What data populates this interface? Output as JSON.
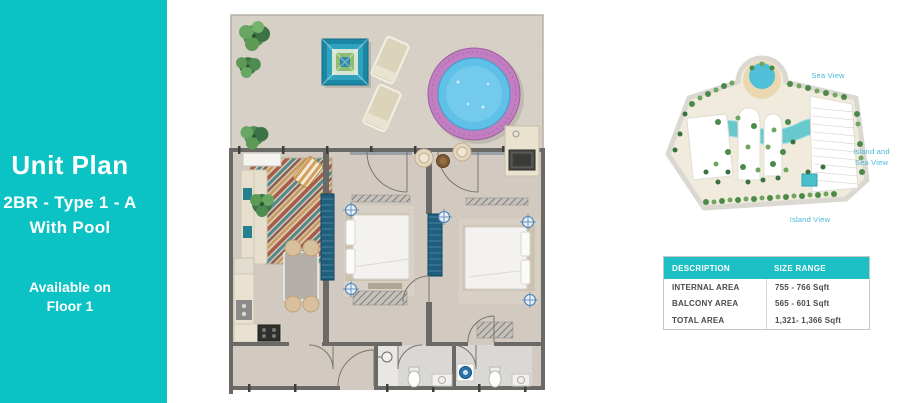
{
  "panel": {
    "title": "Unit Plan",
    "type_line": "2BR - Type 1 - A",
    "feature_line": "With Pool",
    "availability_line1": "Available on",
    "availability_line2": "Floor 1"
  },
  "key_plan": {
    "labels": {
      "sea_view": "Sea View",
      "island_sea_line1": "Island and",
      "island_sea_line2": "Sea View",
      "island_view": "Island View"
    }
  },
  "area_table": {
    "headers": [
      "DESCRIPTION",
      "SIZE RANGE"
    ],
    "rows": [
      {
        "description": "INTERNAL AREA",
        "size_range": "755 - 766 Sqft"
      },
      {
        "description": "BALCONY AREA",
        "size_range": "565 - 601 Sqft"
      },
      {
        "description": "TOTAL AREA",
        "size_range": "1,321- 1,366 Sqft"
      }
    ]
  },
  "colors": {
    "accent_teal": "#0bc3c5",
    "table_header_teal": "#1cbfc4",
    "keyplan_label_teal": "#4cb8d8",
    "pool_water": "#5fc0e8",
    "pool_ring": "#c17ec1"
  }
}
